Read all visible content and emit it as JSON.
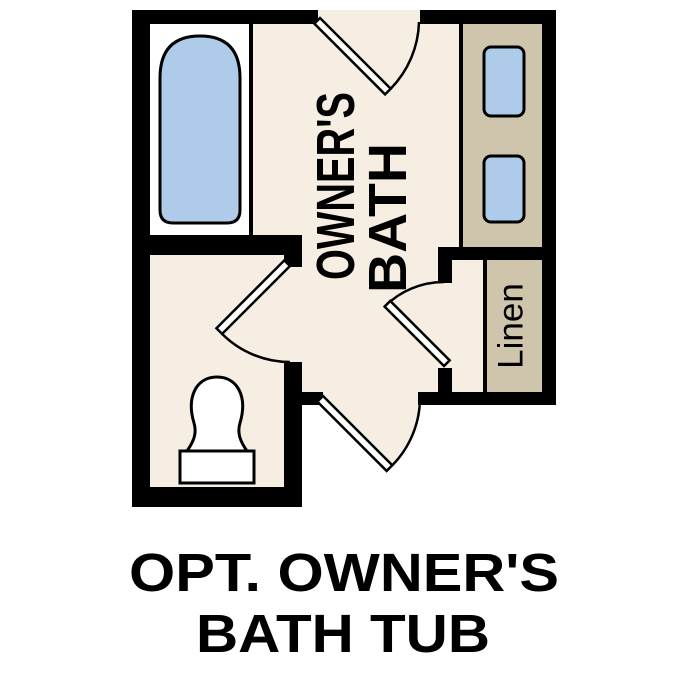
{
  "figure": {
    "type": "floor-plan",
    "room_label": {
      "line1": "OWNER'S",
      "line2": "BATH"
    },
    "linen_label": "Linen",
    "fixtures": [
      "bathtub",
      "vanity-sink-left",
      "vanity-sink-right",
      "toilet",
      "linen-closet",
      "vanity-counter"
    ],
    "door_count": 4
  },
  "caption": {
    "line1": "OPT. OWNER'S",
    "line2": "BATH TUB"
  },
  "colors": {
    "background": "#ffffff",
    "wall": "#000000",
    "floor": "#f6eee2",
    "counter": "#cfc4ac",
    "water_blue": "#aecbea",
    "fixture_white": "#ffffff"
  }
}
